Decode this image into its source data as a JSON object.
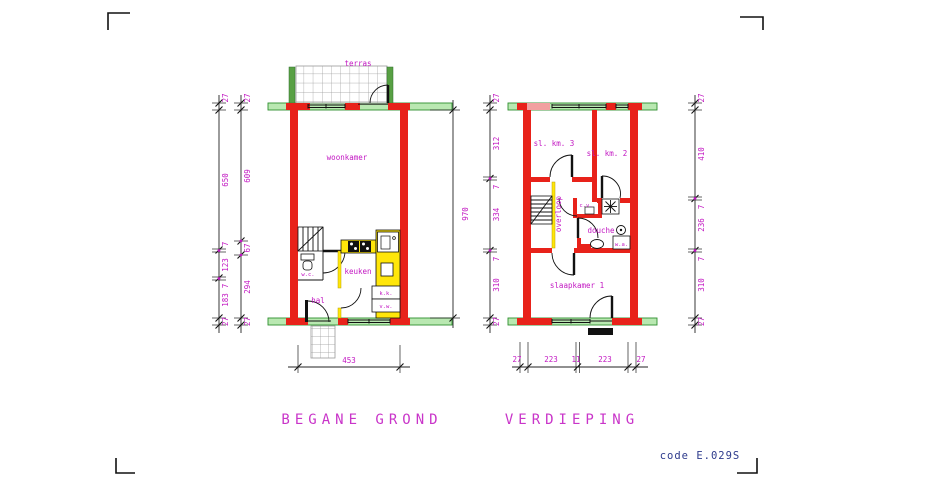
{
  "colors": {
    "wall_red": "#e8221a",
    "band_green_fill": "#b9e8b1",
    "band_green_stroke": "#2f8f2f",
    "accent_magenta": "#c217c2",
    "fixture_yellow": "#ffe60a",
    "party_wall_pink": "#f2a0a0",
    "code_blue": "#2d3a8c"
  },
  "ground_floor": {
    "title": "BEGANE GROND",
    "rooms": {
      "terras": "terras",
      "woonkamer": "woonkamer",
      "keuken": "keuken",
      "hal": "hal",
      "wc": "w.c.",
      "kk": "k.k.",
      "vw": "v.w."
    },
    "dims": {
      "outer_left": [
        "27",
        "650",
        "7",
        "123",
        "7",
        "183",
        "27"
      ],
      "inner_left": [
        "27",
        "609",
        "67",
        "294",
        "27"
      ],
      "bottom_width": "453",
      "total_height": "970"
    }
  },
  "upper_floor": {
    "title": "VERDIEPING",
    "rooms": {
      "bedroom3": "sl. km. 3",
      "bedroom2": "sl. km. 2",
      "landing": "overloop",
      "cv": "c.v.",
      "douche": "douche",
      "wa": "w.a.",
      "bedroom1": "slaapkamer 1"
    },
    "dims": {
      "left": [
        "27",
        "312",
        "7",
        "334",
        "7",
        "310",
        "27"
      ],
      "right": [
        "27",
        "410",
        "7",
        "236",
        "7",
        "310",
        "27"
      ],
      "bottom": [
        "27",
        "223",
        "11",
        "223",
        "27"
      ]
    }
  },
  "footer": {
    "code": "code E.029S"
  }
}
